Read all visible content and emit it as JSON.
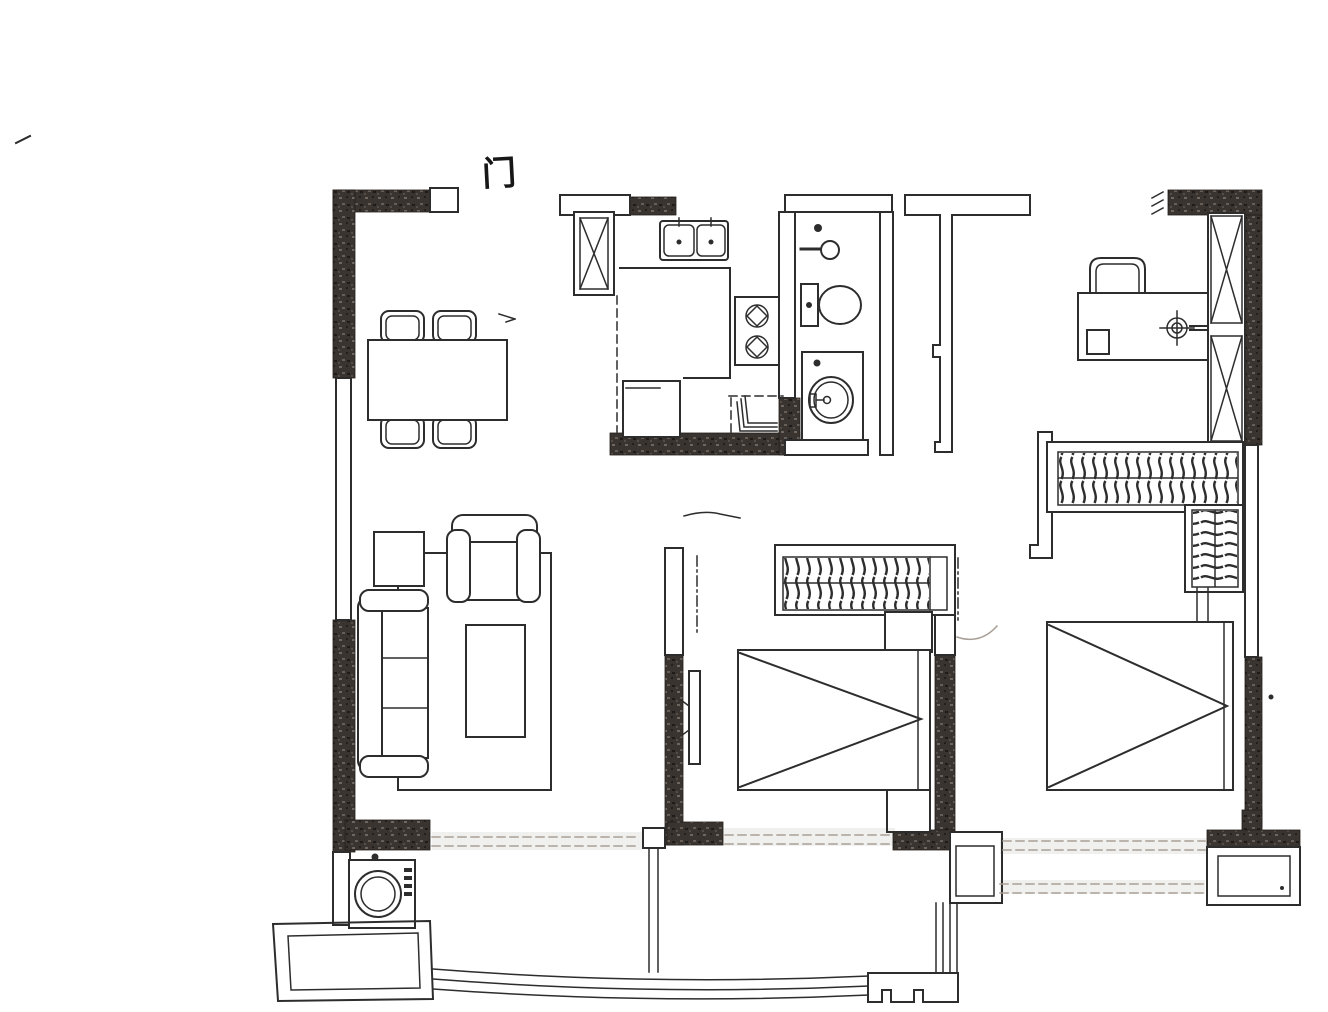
{
  "drawing": {
    "entry_label": "门",
    "kind": "scanned-apartment-floor-plan"
  },
  "colors": {
    "background": "#ffffff",
    "ink": "#2d2d2d",
    "wall_fill": "#3a3430",
    "wall_speck": "#6f675f",
    "faint": "#a89f96"
  },
  "fixtures": [
    "entry-door",
    "dining-table",
    "dining-chair",
    "kitchen-flue-shaft",
    "kitchen-sink",
    "kitchen-counter",
    "gas-stove",
    "fridge",
    "folding-door",
    "floor-drain",
    "shower-head",
    "toilet",
    "washbasin-vanity",
    "hallway-wall",
    "study-desk",
    "desk-chair",
    "ceiling-light",
    "casement-window",
    "wardrobe-hangers",
    "nightstand",
    "double-bed",
    "tv-panel",
    "sofa",
    "armchair",
    "side-table",
    "coffee-table",
    "rug",
    "washing-machine",
    "planter-box",
    "balcony-railing",
    "balcony-divider",
    "ac-platform"
  ]
}
